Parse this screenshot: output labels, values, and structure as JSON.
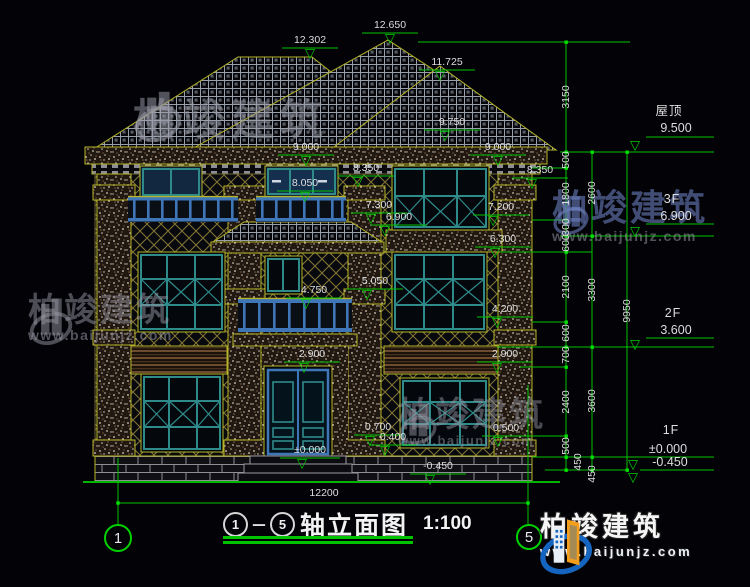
{
  "drawing": {
    "title": {
      "axis_from": "1",
      "axis_to": "5",
      "dash": "－",
      "name": "轴立面图",
      "scale": "1:100"
    },
    "axes": {
      "left": "1",
      "right": "5"
    },
    "brand": {
      "name": "柏竣建筑",
      "url": "www.baijunjz.com"
    },
    "colors": {
      "dim_green": "#00c400",
      "outline_yellow": "#b5b428",
      "frame_teal": "#2f8a8a",
      "frame_blue": "#3f76b8",
      "text_white": "#dedede",
      "logo_blue": "#1565c0",
      "logo_orange": "#f59e1b"
    }
  },
  "annotations": {
    "dims": [
      {
        "t": "12.302",
        "x": 310,
        "y": 40,
        "ax": 310,
        "ay": 53
      },
      {
        "t": "12.650",
        "x": 390,
        "y": 25,
        "ax": 390,
        "ay": 38
      },
      {
        "t": "11.725",
        "x": 447,
        "y": 62,
        "ax": 440,
        "ay": 75
      },
      {
        "t": "9.750",
        "x": 452,
        "y": 122,
        "ax": 445,
        "ay": 135
      },
      {
        "t": "9.000",
        "x": 306,
        "y": 147,
        "ax": 306,
        "ay": 160
      },
      {
        "t": "9.000",
        "x": 498,
        "y": 147,
        "ax": 498,
        "ay": 160
      },
      {
        "t": "8.350",
        "x": 366,
        "y": 168,
        "ax": 358,
        "ay": 181
      },
      {
        "t": "8.350",
        "x": 540,
        "y": 170,
        "ax": 532,
        "ay": 183
      },
      {
        "t": "8.050",
        "x": 305,
        "y": 183,
        "ax": 305,
        "ay": 196
      },
      {
        "t": "7.300",
        "x": 379,
        "y": 205,
        "ax": 371,
        "ay": 218
      },
      {
        "t": "6.900",
        "x": 399,
        "y": 217,
        "ax": 385,
        "ay": 230
      },
      {
        "t": "7.200",
        "x": 501,
        "y": 207,
        "ax": 493,
        "ay": 220
      },
      {
        "t": "6.300",
        "x": 503,
        "y": 239,
        "ax": 495,
        "ay": 252
      },
      {
        "t": "5.050",
        "x": 375,
        "y": 281,
        "ax": 367,
        "ay": 294
      },
      {
        "t": "4.750",
        "x": 314,
        "y": 290,
        "ax": 306,
        "ay": 303
      },
      {
        "t": "4.200",
        "x": 505,
        "y": 309,
        "ax": 497,
        "ay": 322
      },
      {
        "t": "2.900",
        "x": 312,
        "y": 354,
        "ax": 304,
        "ay": 367
      },
      {
        "t": "2.900",
        "x": 505,
        "y": 354,
        "ax": 497,
        "ay": 367
      },
      {
        "t": "0.700",
        "x": 378,
        "y": 427,
        "ax": 370,
        "ay": 440
      },
      {
        "t": "0.400",
        "x": 393,
        "y": 437,
        "ax": 385,
        "ay": 450
      },
      {
        "t": "0.500",
        "x": 506,
        "y": 428,
        "ax": 498,
        "ay": 441
      },
      {
        "t": "±0.000",
        "x": 310,
        "y": 450,
        "ax": 302,
        "ay": 463
      },
      {
        "t": "-0.450",
        "x": 438,
        "y": 466,
        "ax": 430,
        "ay": 479
      },
      {
        "t": "12200",
        "x": 324,
        "y": 493
      }
    ],
    "chains": [
      {
        "t": "3150",
        "x": 566,
        "y": 97
      },
      {
        "t": "500",
        "x": 566,
        "y": 160
      },
      {
        "t": "1800",
        "x": 566,
        "y": 194
      },
      {
        "t": "300",
        "x": 566,
        "y": 227
      },
      {
        "t": "600",
        "x": 566,
        "y": 243
      },
      {
        "t": "2100",
        "x": 566,
        "y": 287
      },
      {
        "t": "600",
        "x": 566,
        "y": 333
      },
      {
        "t": "700",
        "x": 566,
        "y": 355
      },
      {
        "t": "2400",
        "x": 566,
        "y": 402
      },
      {
        "t": "500",
        "x": 566,
        "y": 446
      },
      {
        "t": "450",
        "x": 578,
        "y": 462
      },
      {
        "t": "2600",
        "x": 592,
        "y": 193
      },
      {
        "t": "3300",
        "x": 592,
        "y": 290
      },
      {
        "t": "3600",
        "x": 592,
        "y": 401
      },
      {
        "t": "450",
        "x": 592,
        "y": 474
      },
      {
        "t": "9950",
        "x": 627,
        "y": 311
      }
    ],
    "levels": [
      {
        "t": "屋顶",
        "x": 669,
        "y": 111,
        "cjk": true
      },
      {
        "t": "9.500",
        "x": 676,
        "y": 128,
        "big": true,
        "ax": 635,
        "ay": 145
      },
      {
        "t": "3F",
        "x": 672,
        "y": 199,
        "cjk": true
      },
      {
        "t": "6.900",
        "x": 676,
        "y": 216,
        "big": true,
        "ax": 635,
        "ay": 231
      },
      {
        "t": "2F",
        "x": 673,
        "y": 313,
        "cjk": true
      },
      {
        "t": "3.600",
        "x": 676,
        "y": 330,
        "big": true,
        "ax": 635,
        "ay": 344
      },
      {
        "t": "1F",
        "x": 671,
        "y": 430,
        "cjk": true
      },
      {
        "t": "±0.000",
        "x": 668,
        "y": 449,
        "big": true,
        "ax": 633,
        "ay": 464
      },
      {
        "t": "-0.450",
        "x": 670,
        "y": 462,
        "big": true,
        "ax": 633,
        "ay": 477
      }
    ]
  }
}
